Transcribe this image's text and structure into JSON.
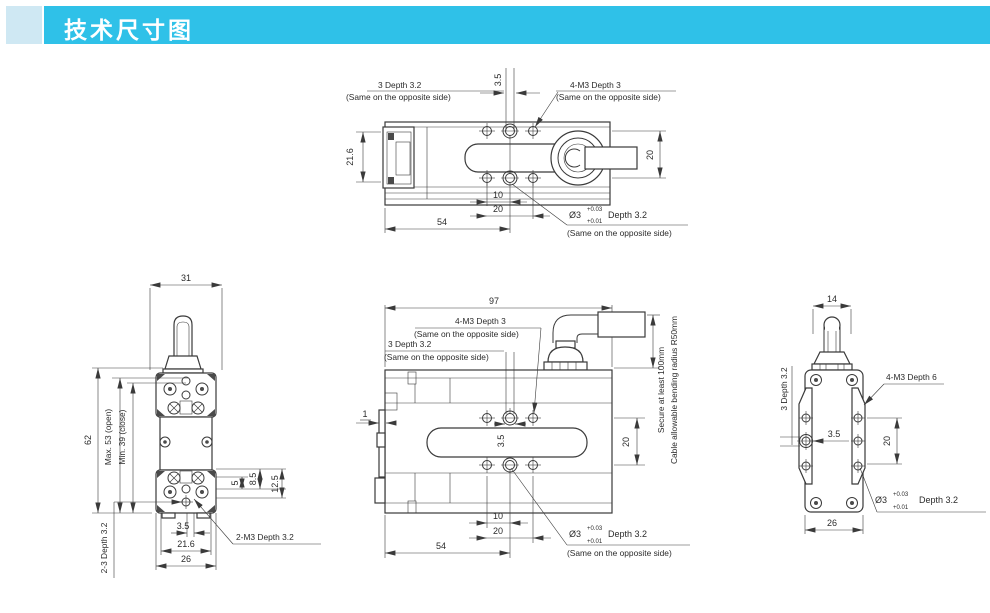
{
  "header": {
    "title": "技术尺寸图"
  },
  "colors": {
    "accent": "#2fc1e8",
    "accent_light": "#cfe8f3",
    "line": "#3a3a3a",
    "background": "#ffffff"
  },
  "common": {
    "same_note": "(Same on the opposite side)",
    "dia": "Ø3",
    "tol_up": "+0.03",
    "tol_dn": "+0.01",
    "depth_3_2": "Depth 3.2"
  },
  "top_view": {
    "dim_3_5": "3.5",
    "note_3_depth": "3 Depth 3.2",
    "note_4m3": "4-M3 Depth 3",
    "dim_21_6": "21.6",
    "dim_20_side": "20",
    "dim_10": "10",
    "dim_20_bottom": "20",
    "dim_54": "54"
  },
  "front_view": {
    "dim_31": "31",
    "dim_62": "62",
    "dim_max": "Max. 53 (open)",
    "dim_min": "Min. 39 (close)",
    "dim_5": "5",
    "dim_8_5": "8.5",
    "dim_12_5": "12.5",
    "dim_3_5": "3.5",
    "dim_21_6": "21.6",
    "dim_26": "26",
    "note_2_3_depth": "2-3 Depth 3.2",
    "note_2m3": "2-M3 Depth 3.2"
  },
  "side_view": {
    "dim_97": "97",
    "note_4m3": "4-M3 Depth 3",
    "note_3_depth": "3 Depth 3.2",
    "dim_1": "1",
    "dim_3_5": "3.5",
    "dim_20_side": "20",
    "dim_10": "10",
    "dim_20_bottom": "20",
    "dim_54": "54",
    "note_secure": "Secure at least 100mm",
    "note_cable": "Cable allowable bending radius R50mm"
  },
  "end_view": {
    "dim_14": "14",
    "note_3_depth": "3 Depth 3.2",
    "note_4m3": "4-M3 Depth 6",
    "dim_3_5": "3.5",
    "dim_20": "20",
    "dim_26": "26"
  }
}
